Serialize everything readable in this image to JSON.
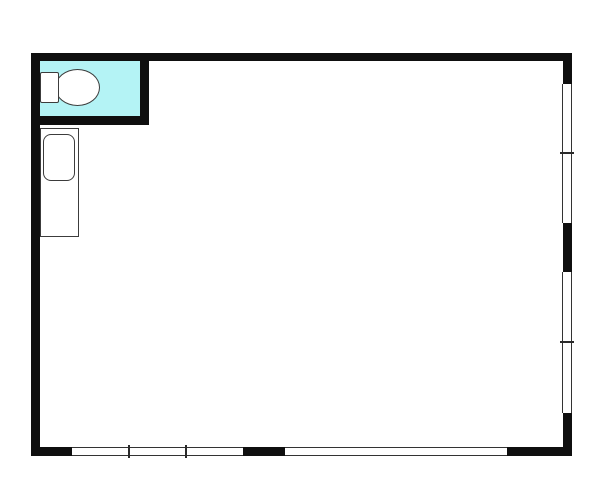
{
  "canvas": {
    "width": 600,
    "height": 484,
    "background": "#ffffff"
  },
  "palette": {
    "wall": "#0f0f0f",
    "window_line": "#333333",
    "mullion_line": "#2a2a2a",
    "fixture_outline": "#3c3c3c",
    "fixture_fill": "#ffffff",
    "toilet_room_fill": "#b4f3f5",
    "floor_fill": "#ffffff"
  },
  "floorplan": {
    "rooms": [
      {
        "name": "main-room",
        "x": 40,
        "y": 61,
        "w": 523,
        "h": 386,
        "fill": "#ffffff"
      },
      {
        "name": "toilet-room",
        "x": 40,
        "y": 61,
        "w": 100,
        "h": 55,
        "fill": "#b4f3f5"
      }
    ],
    "walls": [
      {
        "name": "wall-top",
        "x": 31,
        "y": 53,
        "w": 541,
        "h": 8
      },
      {
        "name": "wall-left",
        "x": 31,
        "y": 53,
        "w": 9,
        "h": 403
      },
      {
        "name": "wall-right-upper",
        "x": 563,
        "y": 53,
        "w": 9,
        "h": 31
      },
      {
        "name": "wall-right-middle",
        "x": 563,
        "y": 223,
        "w": 9,
        "h": 49
      },
      {
        "name": "wall-right-lower",
        "x": 563,
        "y": 413,
        "w": 9,
        "h": 43
      },
      {
        "name": "wall-bottom-left",
        "x": 31,
        "y": 447,
        "w": 41,
        "h": 9
      },
      {
        "name": "wall-bottom-middle",
        "x": 243,
        "y": 447,
        "w": 42,
        "h": 9
      },
      {
        "name": "wall-bottom-right",
        "x": 507,
        "y": 447,
        "w": 65,
        "h": 9
      },
      {
        "name": "toilet-room-wall-right",
        "x": 140,
        "y": 53,
        "w": 9,
        "h": 72
      },
      {
        "name": "toilet-room-wall-bottom",
        "x": 31,
        "y": 116,
        "w": 118,
        "h": 9
      }
    ],
    "windows": [
      {
        "name": "window-right-upper",
        "orientation": "v",
        "x": 562,
        "y": 84,
        "w": 10,
        "h": 139,
        "ticks": [
          69
        ]
      },
      {
        "name": "window-right-lower",
        "orientation": "v",
        "x": 562,
        "y": 272,
        "w": 10,
        "h": 141,
        "ticks": [
          70
        ]
      },
      {
        "name": "window-bottom-left",
        "orientation": "h",
        "x": 72,
        "y": 447,
        "w": 171,
        "h": 9,
        "ticks": [
          57,
          114
        ]
      },
      {
        "name": "window-bottom-right",
        "orientation": "h",
        "x": 285,
        "y": 447,
        "w": 222,
        "h": 9,
        "ticks": []
      }
    ],
    "fixtures": [
      {
        "name": "toilet-bowl",
        "shape": "ellipse",
        "x": 55,
        "y": 69,
        "w": 45,
        "h": 37,
        "radius": 0
      },
      {
        "name": "toilet-tank",
        "shape": "rect",
        "x": 40,
        "y": 72,
        "w": 19,
        "h": 31,
        "radius": 2
      },
      {
        "name": "sink-counter",
        "shape": "rect",
        "x": 40,
        "y": 128,
        "w": 39,
        "h": 109,
        "radius": 0
      },
      {
        "name": "sink-basin",
        "shape": "rounded-rect",
        "x": 43,
        "y": 134,
        "w": 32,
        "h": 47,
        "radius": 8
      }
    ]
  }
}
